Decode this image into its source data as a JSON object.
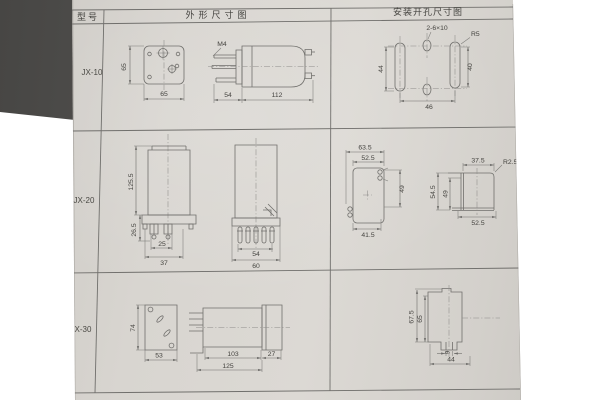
{
  "colors": {
    "paper": "#d8d5d0",
    "surface": "#474644",
    "line": "#706f6c",
    "ink": "#454440"
  },
  "header": {
    "model": "型号",
    "outline": "外形尺寸图",
    "mounting": "安装开孔尺寸图"
  },
  "rows": [
    {
      "model": "JX-10",
      "outline": {
        "front_h": "65",
        "front_w": "65",
        "thread": "M4",
        "pin_len": "54",
        "body_len": "112"
      },
      "mounting": {
        "slot_note": "2-6×10",
        "radius": "R5",
        "left_h": "44",
        "right_h": "40",
        "span": "46"
      }
    },
    {
      "model": "JX-20",
      "outline": {
        "height": "125.5",
        "base_h": "26.5",
        "inner_w": "25",
        "outer_w": "37",
        "pin_span": "54",
        "width": "60"
      },
      "mounting": {
        "outer_w": "63.5",
        "inner_w": "52.5",
        "height": "49",
        "bottom_w": "41.5",
        "side_top_w": "37.5",
        "side_radius": "R2.5",
        "side_outer_h": "54.5",
        "side_inner_h": "49",
        "side_bottom_w": "52.5"
      }
    },
    {
      "model": "JX-30",
      "outline": {
        "front_h": "74",
        "front_w": "53",
        "body_len": "103",
        "cap_len": "27",
        "total_len": "125"
      },
      "mounting": {
        "outer_h": "67.5",
        "inner_h": "65",
        "slot_w": "9",
        "bottom_w": "44"
      }
    }
  ]
}
